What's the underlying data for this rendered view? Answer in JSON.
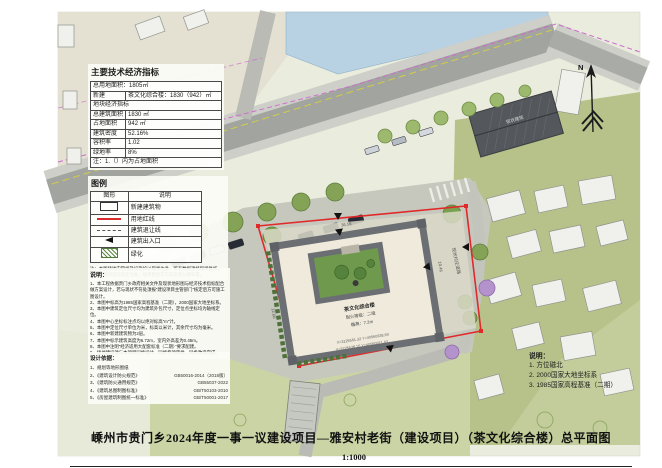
{
  "sheet": {
    "title": "嵊州市贵门乡2024年度一事一议建设项目—雅安村老街（建设项目）（茶文化综合楼）总平面图",
    "scale": "1:1000"
  },
  "indicators": {
    "title": "主要技术经济指标",
    "land_area": "总用地面积：1805㎡",
    "new_label": "新建",
    "new_value": "茶文化综合楼：1830（942）㎡",
    "section": "地块经济指标",
    "rows": [
      {
        "label": "总建筑面积",
        "value": "1830 ㎡"
      },
      {
        "label": "占地面积",
        "value": "942 ㎡"
      },
      {
        "label": "建筑密度",
        "value": "52.16%"
      },
      {
        "label": "容积率",
        "value": "1.02"
      },
      {
        "label": "绿地率",
        "value": "8%"
      }
    ],
    "footnote": "注：1.（）内为占地面积"
  },
  "legend": {
    "title": "图例",
    "col_symbol": "图形",
    "col_desc": "说明",
    "rows": [
      {
        "label": "新建建筑物"
      },
      {
        "label": "用地红线"
      },
      {
        "label": "建筑退让线"
      },
      {
        "label": "建筑出入口"
      },
      {
        "label": "绿化"
      }
    ],
    "note1": "注：本图场地内管线及设施均以现状为准，所有数据须经现场复核，",
    "note2": "车位以现场实际划定为准，经审批后方可实施及分期布置。"
  },
  "notes": {
    "title": "说明：",
    "items": [
      "1、本工程依据贵门乡政府相关文件及现状地形图与经济技术指标配合做方案设计，若与现状不符处须报“建设项目主管部门”核定后方可施工图设计。",
      "2、本图中标高为1985国家高程基准（二期），2000国家大地坐标系。",
      "3、本图中建筑定位尺寸均为建筑外包尺寸，定位点坐标均为轴线定位。",
      "4、本图中心坐标标注点均以绝对标高“m”计。",
      "5、本图中定位尺寸单位为米，标高以米计，其余尺寸均为毫米。",
      "6、本图中新建建筑物为2层。",
      "7、本图中标示建筑高度为6.72m，室内外高差为0.45m。",
      "8、本图中注明“经济适用大配套标准（二期）”要求配建。",
      "9、场地建设须与本项目同步设计、同步专项审批、同步改造完成。"
    ]
  },
  "design_basis": {
    "title": "设计依据：",
    "items": [
      {
        "name": "1、规划等地形图纸",
        "code": ""
      },
      {
        "name": "2、《建筑设计防火规范》",
        "code": "GB50016-2014（2018版）"
      },
      {
        "name": "3、《建筑防火通用规范》",
        "code": "GB55037-2022"
      },
      {
        "name": "4、《建筑总图制图标准》",
        "code": "GB/T50103-2010"
      },
      {
        "name": "5、《房屋建筑制图统一标准》",
        "code": "GB/T50001-2017"
      }
    ]
  },
  "map_notes": {
    "title": "说明：",
    "lines": [
      "1. 方位磁北",
      "2. 2000国家大地坐标系",
      "3. 1985国家高程基准（二期）"
    ]
  },
  "site": {
    "north": "N",
    "building_name": "茶文化综合楼",
    "fire_grade": "耐火等级：二级",
    "eave_height": "檐高：7.2m",
    "dim_top": "36.56",
    "dim_left": "12.66",
    "dim_right": "10.46",
    "coord_a": "X=3225561.32 Y=40560938.69",
    "coord_b": "X=3225538.15 Y=40560921.43",
    "existing_building": "现状建筑",
    "road_label": "现状村庄道路"
  },
  "colors": {
    "red_line": "#e02a2a",
    "water": "#b8d2e3",
    "greenfield": "#b6c28a",
    "road": "#a2a4a0",
    "building_wall": "#6b6e72",
    "courtyard_green": "#6f9a4e"
  }
}
